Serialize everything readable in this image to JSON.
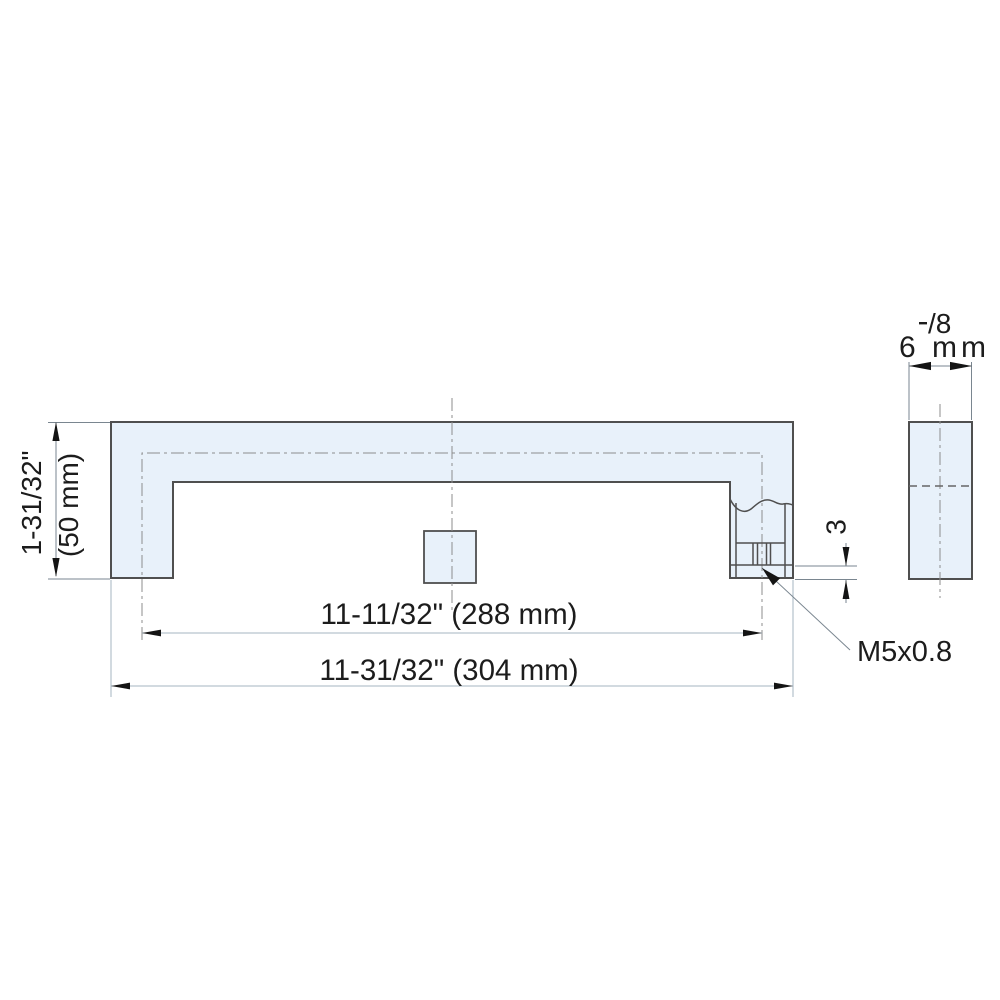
{
  "drawing": {
    "type": "technical-dimension-drawing",
    "views": {
      "front_view": "U-shaped pull handle, front elevation",
      "side_view": "handle bar cross-section, side elevation"
    },
    "dims": {
      "height_in": "1-31/32\"",
      "height_mm": "(50 mm)",
      "hole_centers": "11-11/32\" (288 mm)",
      "overall_length": "11-31/32\" (304 mm)",
      "thread_label": "M5x0.8",
      "thread_offset": "3",
      "side_width_fraction": "/8",
      "side_width_mm": "6 mm"
    },
    "colors": {
      "part_fill": "#e8f1fa",
      "outline": "#4f4f4f",
      "centerline": "#8d8d8d",
      "dimension_line": "#7a8690",
      "dimension_line_light": "#a4b4c0",
      "text": "#1c1c1c",
      "arrow": "#141414"
    }
  }
}
